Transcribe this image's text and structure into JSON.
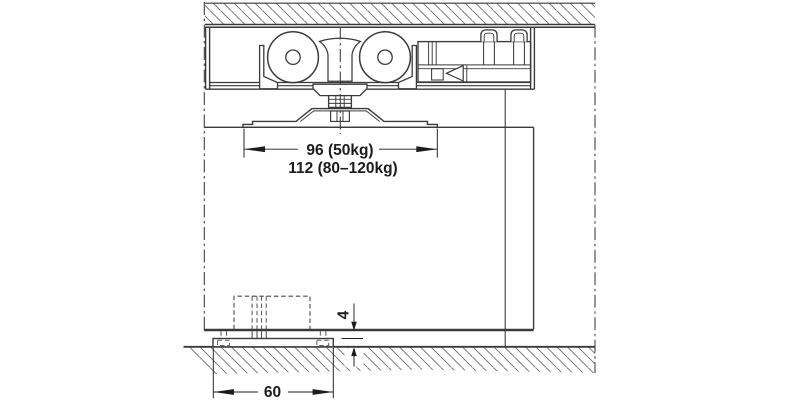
{
  "drawing": {
    "background_color": "#ffffff",
    "line_color": "#3a3a3a",
    "hatch_color": "#6b6b6b",
    "text_color": "#1c1c1c",
    "dimensions": {
      "carriage_width_primary": "96 (50kg)",
      "carriage_width_secondary": "112 (80–120kg)",
      "floor_guide_length": "60",
      "floor_clearance": "4"
    }
  }
}
